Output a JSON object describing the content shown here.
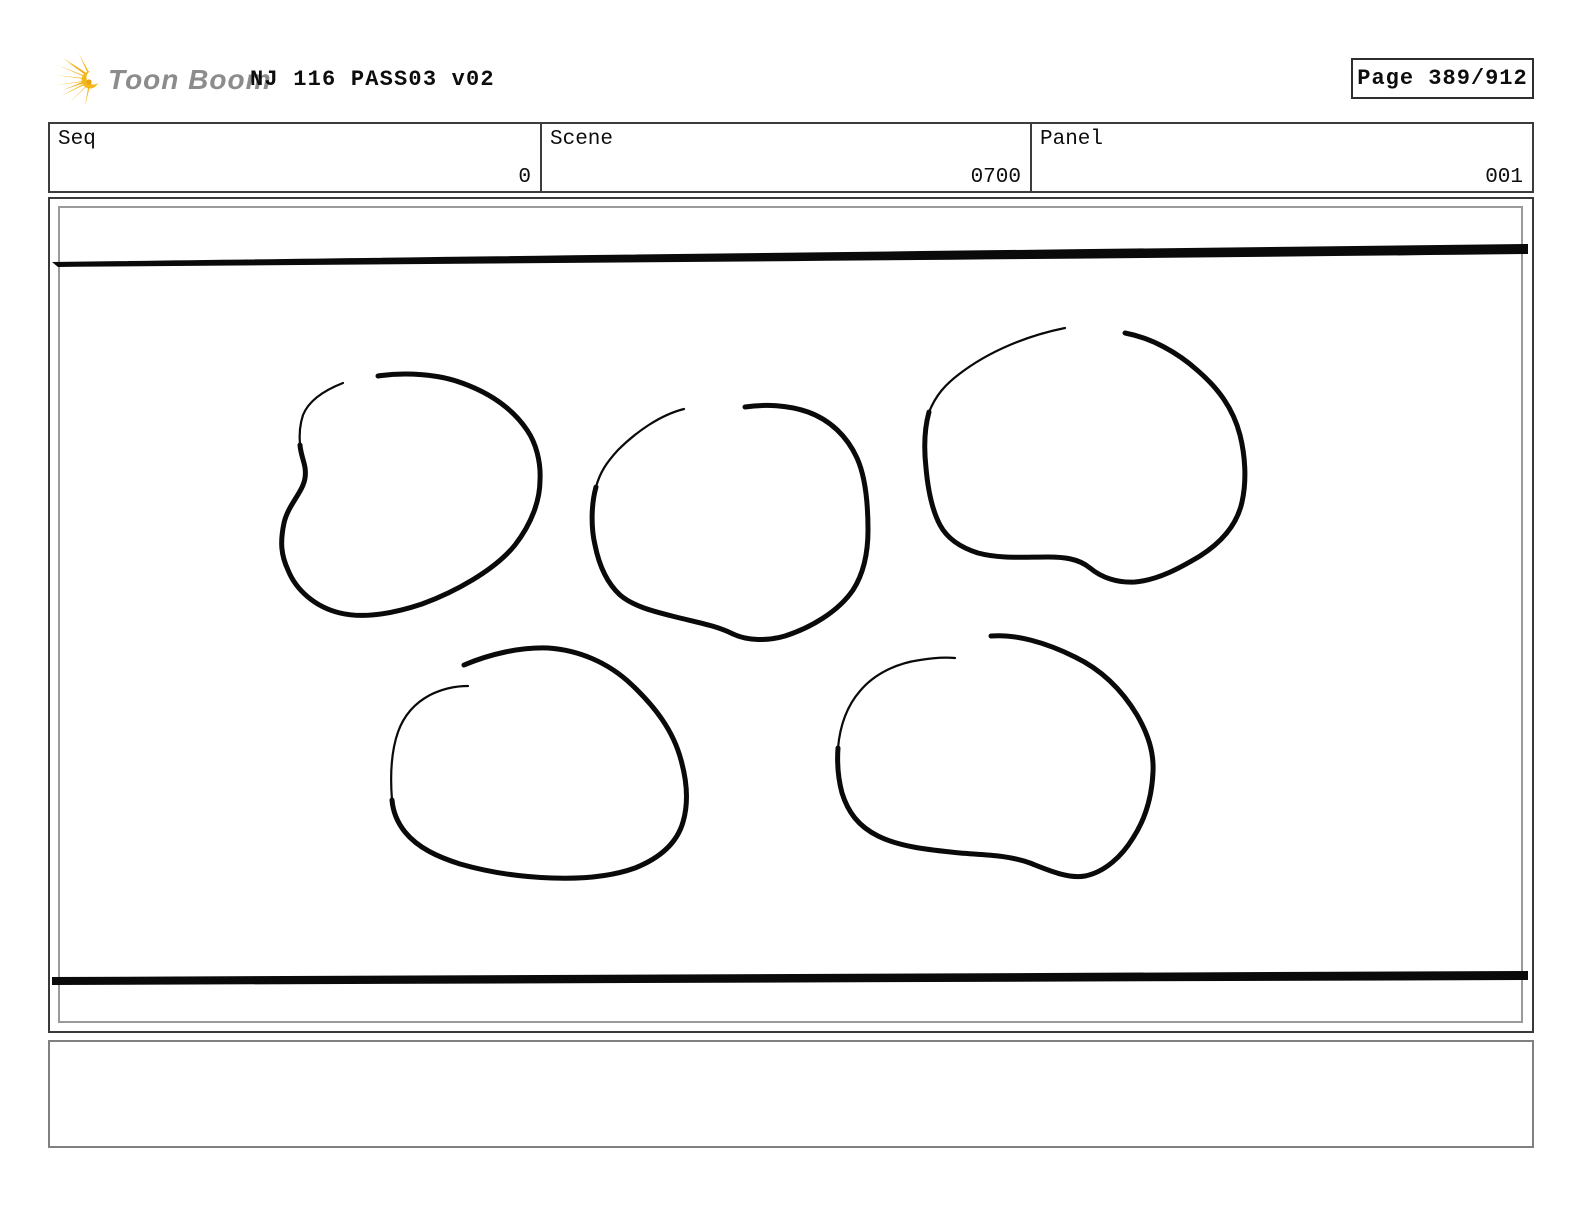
{
  "header": {
    "logo_text": "Toon Boom",
    "title": "NJ 116 PASS03 v02",
    "page_label": "Page 389/912"
  },
  "info_table": {
    "fields": [
      {
        "label": "Seq",
        "value": "0"
      },
      {
        "label": "Scene",
        "value": "0700"
      },
      {
        "label": "Panel",
        "value": "001"
      }
    ]
  },
  "panel": {
    "description": "Rough pencil sketch: five hand-drawn rounded rock/blob outlines arranged in two rows between a thick tapered horizontal line at the top and a thick horizontal line at the bottom"
  },
  "caption": {
    "text": ""
  },
  "colors": {
    "ink": "#0a0a0a",
    "logo_yellow": "#f5b81c",
    "logo_yellow_dark": "#e8a317",
    "logo_gray": "#8c8c8c",
    "inner_frame_gray": "#9a9a9a",
    "caption_border_gray": "#808080"
  }
}
